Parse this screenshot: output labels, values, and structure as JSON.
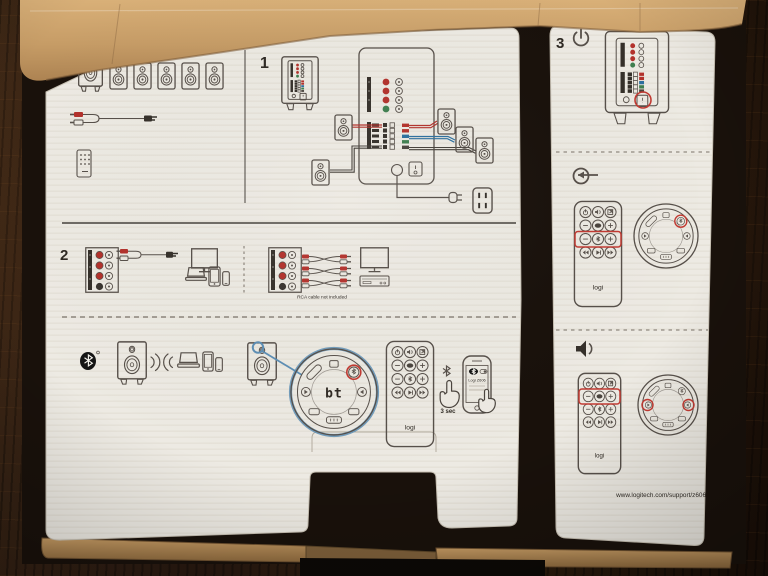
{
  "steps": {
    "step1": "1",
    "step2": "2",
    "step3": "3"
  },
  "left_panel": {
    "rca_note": "RCA cable not included",
    "dial_display": "bt",
    "remote_brand": "logi",
    "bluetooth_hold_time": "3 sec",
    "phone_pairing_device": "Logi Z606"
  },
  "right_panel": {
    "support_url": "www.logitech.com/support/z606"
  },
  "colors": {
    "accent_red": "#b3322c",
    "highlight_red": "#c23a32",
    "accent_blue": "#5d8fb5",
    "wire_blue": "#2c6f9e",
    "wire_green": "#3f7f4f",
    "paper": "#edeae3",
    "cardboard": "#c29b68",
    "wood": "#2a190e"
  }
}
